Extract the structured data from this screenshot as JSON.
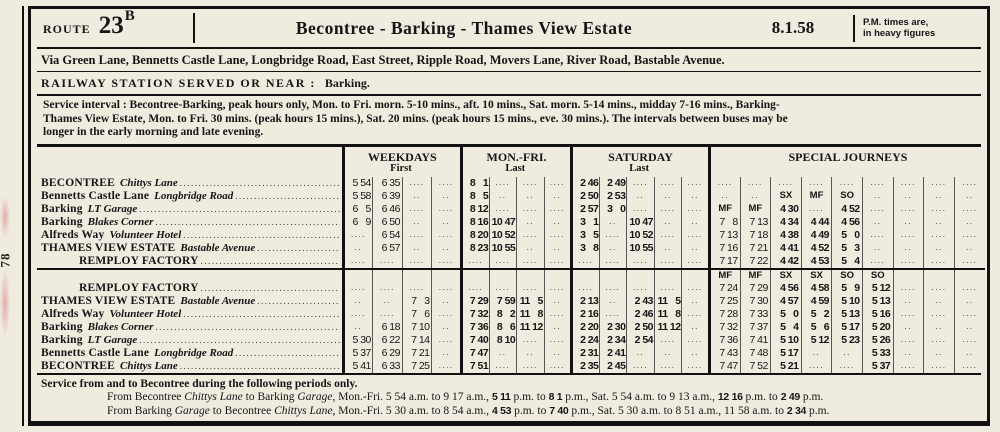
{
  "page": {
    "page_number": "78"
  },
  "header": {
    "route_word": "Route",
    "route_number": "23",
    "route_suffix": "B",
    "title": "Becontree - Barking - Thames View Estate",
    "date": "8.1.58",
    "pm_note_line1": "P.M. times are,",
    "pm_note_line2": "in heavy figures"
  },
  "via_line": "Via Green Lane, Bennetts Castle Lane, Longbridge Road, East Street, Ripple Road, Movers Lane, River Road, Bastable Avenue.",
  "railway": {
    "label": "RAILWAY STATION SERVED OR NEAR :",
    "value": "Barking."
  },
  "service_interval_lines": [
    "Service interval :  Becontree-Barking, peak hours only, Mon. to Fri. morn. 5-10 mins., aft. 10 mins., Sat. morn. 5-14 mins., midday 7-16 mins., Barking-",
    "Thames View Estate, Mon. to Fri. 30 mins. (peak hours 15 mins.), Sat. 20 mins. (peak hours 15 mins., eve. 30 mins.).   The intervals between buses may be",
    "longer in the early morning and late evening."
  ],
  "timetable": {
    "groups": [
      {
        "key": "wk",
        "title": "WEEKDAYS",
        "sub": "First",
        "cols": 4
      },
      {
        "key": "mf",
        "title": "MON.-FRI.",
        "sub": "Last",
        "cols": 4
      },
      {
        "key": "sat",
        "title": "SATURDAY",
        "sub": "Last",
        "cols": 5
      },
      {
        "key": "sp",
        "title": "SPECIAL JOURNEYS",
        "sub": "",
        "cols": 9
      }
    ],
    "blocks": [
      {
        "day_header": null,
        "rows": [
          {
            "station": {
              "main": "BECONTREE",
              "sub": "Chittys Lane",
              "indent": false
            },
            "wk": [
              "5 54",
              "6 35",
              "....",
              "...."
            ],
            "mf": [
              "8 1",
              "....",
              "....",
              "...."
            ],
            "sat": [
              "2 46",
              "2 49",
              "....",
              "....",
              "...."
            ],
            "sp": [
              "....",
              "....",
              "....",
              "....",
              "....",
              "....",
              "....",
              "....",
              "...."
            ]
          },
          {
            "station": {
              "main": "Bennetts Castle Lane",
              "sub": "Longbridge Road",
              "indent": false
            },
            "wk": [
              "5 58",
              "6 39",
              "..",
              ".."
            ],
            "mf": [
              "8 5",
              "..",
              "..",
              ".."
            ],
            "sat": [
              "2 50",
              "2 53",
              "..",
              "..",
              ".."
            ],
            "sp": [
              "..",
              "..",
              "SX",
              "MF",
              "SO",
              "..",
              "..",
              "..",
              ".."
            ]
          },
          {
            "station": {
              "main": "Barking",
              "sub": "LT Garage",
              "indent": false
            },
            "wk": [
              "6 5",
              "6 46",
              "....",
              "...."
            ],
            "mf": [
              "8 12",
              "....",
              "....",
              "...."
            ],
            "sat": [
              "2 57",
              "3 0",
              "....",
              "....",
              "...."
            ],
            "sp": [
              "MF",
              "MF",
              "4 30",
              "....",
              "4 52",
              "....",
              "....",
              "....",
              "...."
            ]
          },
          {
            "station": {
              "main": "Barking",
              "sub": "Blakes Corner",
              "indent": false
            },
            "wk": [
              "6 9",
              "6 50",
              "..",
              ".."
            ],
            "mf": [
              "8 16",
              "10 47",
              "..",
              ".."
            ],
            "sat": [
              "3 1",
              "..",
              "10 47",
              "..",
              ".."
            ],
            "sp": [
              "7 8",
              "7 13",
              "4 34",
              "4 44",
              "4 56",
              "..",
              "..",
              "..",
              ".."
            ]
          },
          {
            "station": {
              "main": "Alfreds Way",
              "sub": "Volunteer Hotel",
              "indent": false
            },
            "wk": [
              "....",
              "6 54",
              "....",
              "...."
            ],
            "mf": [
              "8 20",
              "10 52",
              "....",
              "...."
            ],
            "sat": [
              "3 5",
              "....",
              "10 52",
              "....",
              "...."
            ],
            "sp": [
              "7 13",
              "7 18",
              "4 38",
              "4 49",
              "5 0",
              "....",
              "....",
              "....",
              "...."
            ]
          },
          {
            "station": {
              "main": "THAMES VIEW ESTATE",
              "sub": "Bastable Avenue",
              "indent": false
            },
            "wk": [
              "..",
              "6 57",
              "..",
              ".."
            ],
            "mf": [
              "8 23",
              "10 55",
              "..",
              ".."
            ],
            "sat": [
              "3 8",
              "..",
              "10 55",
              "..",
              ".."
            ],
            "sp": [
              "7 16",
              "7 21",
              "4 41",
              "4 52",
              "5 3",
              "..",
              "..",
              "..",
              ".."
            ]
          },
          {
            "station": {
              "main": "REMPLOY FACTORY",
              "sub": "",
              "indent": true
            },
            "wk": [
              "....",
              "....",
              "....",
              "...."
            ],
            "mf": [
              "....",
              "....",
              "....",
              "...."
            ],
            "sat": [
              "....",
              "....",
              "....",
              "....",
              "...."
            ],
            "sp": [
              "7 17",
              "7 22",
              "4 42",
              "4 53",
              "5 4",
              "....",
              "....",
              "....",
              "...."
            ]
          }
        ]
      },
      {
        "day_header": {
          "sp": [
            "MF",
            "MF",
            "SX",
            "SX",
            "SO",
            "SO",
            "",
            "",
            ""
          ]
        },
        "rows": [
          {
            "station": {
              "main": "REMPLOY FACTORY",
              "sub": "",
              "indent": true
            },
            "wk": [
              "....",
              "....",
              "....",
              "...."
            ],
            "mf": [
              "....",
              "....",
              "....",
              "...."
            ],
            "sat": [
              "....",
              "....",
              "....",
              "....",
              "...."
            ],
            "sp": [
              "7 24",
              "7 29",
              "4 56",
              "4 58",
              "5 9",
              "5 12",
              "....",
              "....",
              "...."
            ]
          },
          {
            "station": {
              "main": "THAMES VIEW ESTATE",
              "sub": "Bastable Avenue",
              "indent": false
            },
            "wk": [
              "..",
              "..",
              "7 3",
              ".."
            ],
            "mf": [
              "7 29",
              "7 59",
              "11 5",
              ".."
            ],
            "sat": [
              "2 13",
              "..",
              "2 43",
              "11 5",
              ".."
            ],
            "sp": [
              "7 25",
              "7 30",
              "4 57",
              "4 59",
              "5 10",
              "5 13",
              "..",
              "..",
              ".."
            ]
          },
          {
            "station": {
              "main": "Alfreds Way",
              "sub": "Volunteer Hotel",
              "indent": false
            },
            "wk": [
              "....",
              "....",
              "7 6",
              "...."
            ],
            "mf": [
              "7 32",
              "8 2",
              "11 8",
              "...."
            ],
            "sat": [
              "2 16",
              "....",
              "2 46",
              "11 8",
              "...."
            ],
            "sp": [
              "7 28",
              "7 33",
              "5 0",
              "5 2",
              "5 13",
              "5 16",
              "....",
              "....",
              "...."
            ]
          },
          {
            "station": {
              "main": "Barking",
              "sub": "Blakes Corner",
              "indent": false
            },
            "wk": [
              "..",
              "6 18",
              "7 10",
              ".."
            ],
            "mf": [
              "7 36",
              "8 6",
              "11 12",
              ".."
            ],
            "sat": [
              "2 20",
              "2 30",
              "2 50",
              "11 12",
              ".."
            ],
            "sp": [
              "7 32",
              "7 37",
              "5 4",
              "5 6",
              "5 17",
              "5 20",
              "..",
              "..",
              ".."
            ]
          },
          {
            "station": {
              "main": "Barking",
              "sub": "LT Garage",
              "indent": false
            },
            "wk": [
              "5 30",
              "6 22",
              "7 14",
              "...."
            ],
            "mf": [
              "7 40",
              "8 10",
              "....",
              "...."
            ],
            "sat": [
              "2 24",
              "2 34",
              "2 54",
              "....",
              "...."
            ],
            "sp": [
              "7 36",
              "7 41",
              "5 10",
              "5 12",
              "5 23",
              "5 26",
              "....",
              "....",
              "...."
            ]
          },
          {
            "station": {
              "main": "Bennetts Castle Lane",
              "sub": "Longbridge Road",
              "indent": false
            },
            "wk": [
              "5 37",
              "6 29",
              "7 21",
              ".."
            ],
            "mf": [
              "7 47",
              "..",
              "..",
              ".."
            ],
            "sat": [
              "2 31",
              "2 41",
              "..",
              "..",
              ".."
            ],
            "sp": [
              "7 43",
              "7 48",
              "5 17",
              "..",
              "..",
              "5 33",
              "..",
              "..",
              ".."
            ]
          },
          {
            "station": {
              "main": "BECONTREE",
              "sub": "Chittys Lane",
              "indent": false
            },
            "wk": [
              "5 41",
              "6 33",
              "7 25",
              "...."
            ],
            "mf": [
              "7 51",
              "....",
              "....",
              "...."
            ],
            "sat": [
              "2 35",
              "2 45",
              "....",
              "....",
              "...."
            ],
            "sp": [
              "7 47",
              "7 52",
              "5 21",
              "....",
              "....",
              "5 37",
              "....",
              "....",
              "...."
            ]
          }
        ]
      }
    ]
  },
  "footer": {
    "intro": "Service from and to Becontree during the following periods only.",
    "lines": [
      [
        {
          "t": "From Becontree "
        },
        {
          "t": "Chittys Lane",
          "i": 1
        },
        {
          "t": " to Barking "
        },
        {
          "t": "Garage",
          "i": 1
        },
        {
          "t": ", Mon.-Fri. 5 54 a.m. to 9 17 a.m., "
        },
        {
          "t": "5 11",
          "b": 1
        },
        {
          "t": " p.m. to "
        },
        {
          "t": "8 1",
          "b": 1
        },
        {
          "t": " p.m., Sat. 5 54 a.m. to 9 13 a.m., "
        },
        {
          "t": "12 16",
          "b": 1
        },
        {
          "t": " p.m. to "
        },
        {
          "t": "2 49",
          "b": 1
        },
        {
          "t": " p.m."
        }
      ],
      [
        {
          "t": "From Barking "
        },
        {
          "t": "Garage",
          "i": 1
        },
        {
          "t": " to Becontree "
        },
        {
          "t": "Chittys Lane",
          "i": 1
        },
        {
          "t": ", Mon.-Fri. 5 30 a.m. to 8 54 a.m., "
        },
        {
          "t": "4 53",
          "b": 1
        },
        {
          "t": " p.m. to "
        },
        {
          "t": "7 40",
          "b": 1
        },
        {
          "t": " p.m., Sat. 5 30 a.m. to 8 51 a.m., 11 58 a.m. to "
        },
        {
          "t": "2 34",
          "b": 1
        },
        {
          "t": " p.m."
        }
      ]
    ]
  }
}
